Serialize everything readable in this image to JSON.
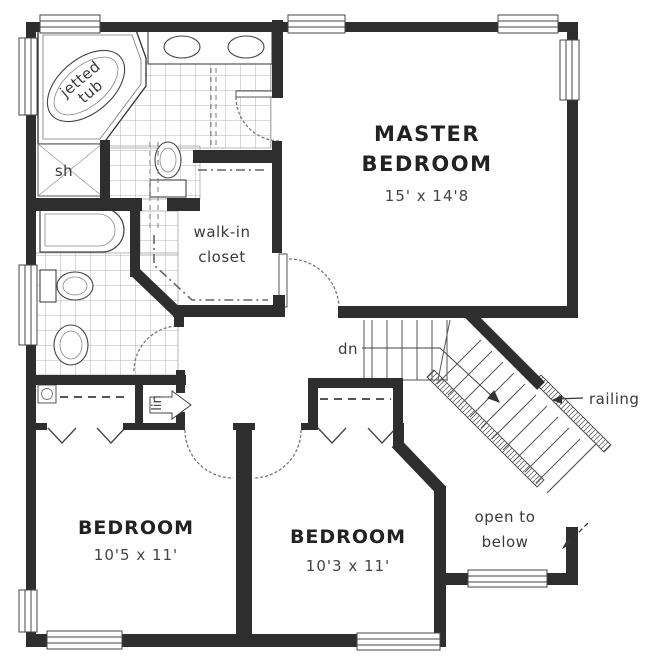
{
  "document_type": "floor-plan",
  "rooms": {
    "master_bedroom": {
      "name_line1": "MASTER",
      "name_line2": "BEDROOM",
      "dimensions": "15' x 14'8"
    },
    "bedroom_left": {
      "name": "BEDROOM",
      "dimensions": "10'5 x 11'"
    },
    "bedroom_middle": {
      "name": "BEDROOM",
      "dimensions": "10'3 x 11'"
    },
    "walk_in_closet": {
      "label_line1": "walk-in",
      "label_line2": "closet"
    }
  },
  "annotations": {
    "stairs_down": "dn",
    "railing": "railing",
    "open_to_below_line1": "open to",
    "open_to_below_line2": "below",
    "jetted_tub_line1": "jetted",
    "jetted_tub_line2": "tub",
    "shower": "sh",
    "linen_closet": "lin"
  },
  "colors": {
    "wall": "#2e2e2e",
    "thin_line": "#555555",
    "tile_line": "#b3b3b3",
    "text": "#333333",
    "background": "#ffffff"
  }
}
